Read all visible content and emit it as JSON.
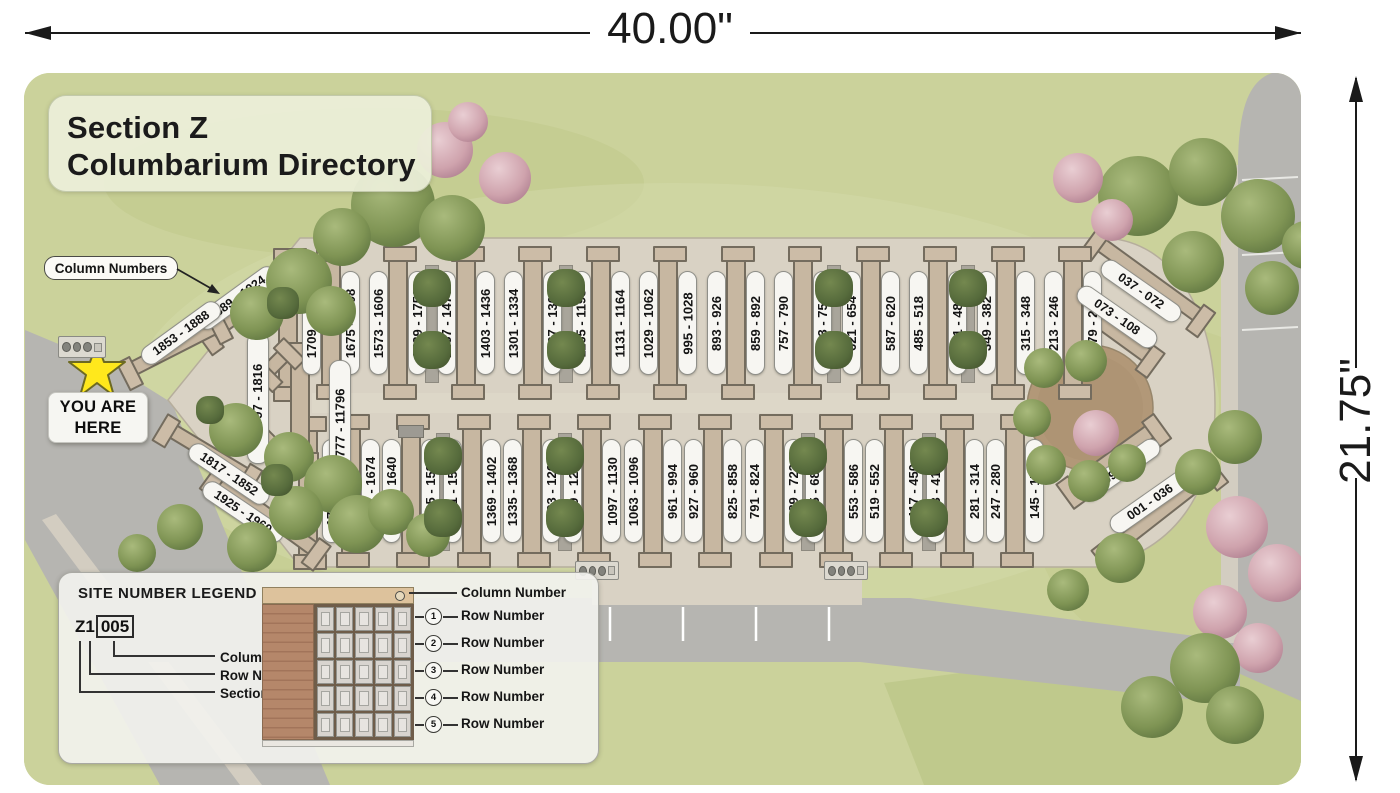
{
  "dimensions": {
    "width": "40.00\"",
    "height": "21.75\""
  },
  "title": {
    "line1": "Section Z",
    "line2": "Columbarium Directory"
  },
  "callouts": {
    "column_numbers": "Column Numbers"
  },
  "you_are_here": {
    "line1": "YOU ARE",
    "line2": "HERE"
  },
  "rows": {
    "top": [
      "1709 - 1742",
      "1675 - 1708",
      "1573 - 1606",
      "1539 - 1752",
      "1437 - 1470",
      "1403 - 1436",
      "1301 - 1334",
      "1267 - 1300",
      "1165 - 1198",
      "1131 - 1164",
      "1029 - 1062",
      "995 - 1028",
      "893 - 926",
      "859 - 892",
      "757 - 790",
      "723 - 756",
      "621 - 654",
      "587 - 620",
      "485 - 518",
      "451 - 484",
      "349 - 382",
      "315 - 348",
      "213 - 246",
      "179 - 212"
    ],
    "bottom": [
      "1743 - 1776",
      "1641 - 1674",
      "1607 - 1640",
      "1505 - 1538",
      "1471 - 1504",
      "1369 - 1402",
      "1335 - 1368",
      "1233 - 1266",
      "1199 - 1232",
      "1097 - 1130",
      "1063 - 1096",
      "961 - 994",
      "927 - 960",
      "825 - 858",
      "791 - 824",
      "689 - 722",
      "655 - 688",
      "553 - 586",
      "519 - 552",
      "417 - 450",
      "383 - 416",
      "281 - 314",
      "247 - 280",
      "145 - 178"
    ]
  },
  "arc_labels": {
    "left_top_outer": "1889 - 1924",
    "left_top_inner": "1853 - 1888",
    "left_mid_left": "1797 - 1816",
    "left_mid_right": "1777 - 11796",
    "left_bottom_inner": "1817 - 1852",
    "left_bottom_outer": "1925 - 1960",
    "right_top_outer": "037 - 072",
    "right_top_inner": "073 - 108",
    "right_bottom_inner": "109 - 144",
    "right_bottom_outer": "001 - 036"
  },
  "legend": {
    "heading": "SITE NUMBER LEGEND",
    "code_prefix": "Z1",
    "code_box": "005",
    "code_callouts": [
      "Column Number",
      "Row Number",
      "Section Number"
    ],
    "wall_top_callout": "Column Number",
    "row_label": "Row Number",
    "row_numbers": [
      "1",
      "2",
      "3",
      "4",
      "5"
    ]
  },
  "colors": {
    "grass": "#cbd29b",
    "road": "#b6b5b1",
    "plaza": "#d9d2c4",
    "wall": "#c7b7a1",
    "wall_border": "#746c5e",
    "pill": "#f7f6f2",
    "star": "#ffe81c",
    "garden_circle": "#b29878"
  }
}
